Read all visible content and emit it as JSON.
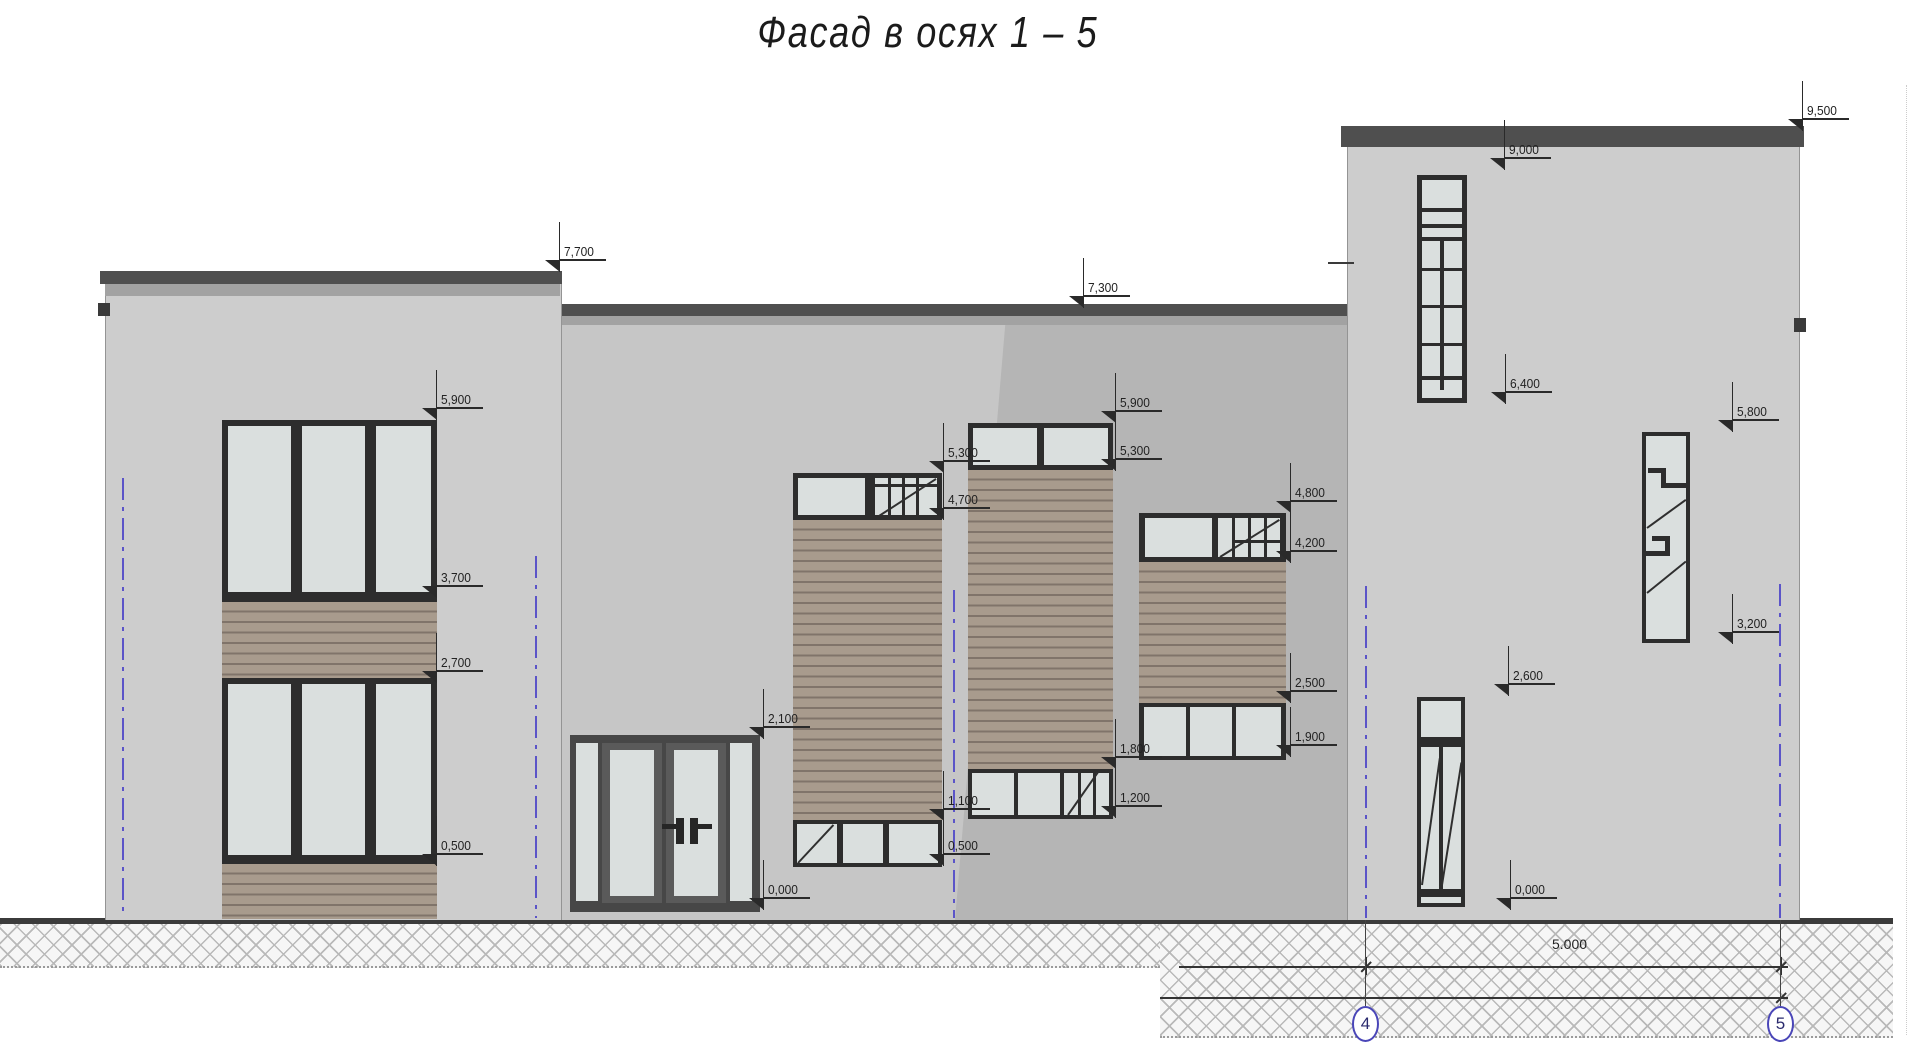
{
  "title": "Фасад в осях 1 – 5",
  "drawing": {
    "type": "architectural-elevation",
    "elevation_markers": [
      {
        "label": "7,700",
        "x": 560,
        "y": 272
      },
      {
        "label": "7,300",
        "x": 1084,
        "y": 308
      },
      {
        "label": "9,500",
        "x": 1803,
        "y": 131
      },
      {
        "label": "9,000",
        "x": 1505,
        "y": 170
      },
      {
        "label": "6,400",
        "x": 1506,
        "y": 404
      },
      {
        "label": "5,900",
        "x": 437,
        "y": 420
      },
      {
        "label": "3,700",
        "x": 437,
        "y": 598
      },
      {
        "label": "2,700",
        "x": 437,
        "y": 683
      },
      {
        "label": "0,500",
        "x": 437,
        "y": 866
      },
      {
        "label": "2,100",
        "x": 764,
        "y": 739
      },
      {
        "label": "0,000",
        "x": 764,
        "y": 910
      },
      {
        "label": "5,300",
        "x": 944,
        "y": 473
      },
      {
        "label": "4,700",
        "x": 944,
        "y": 520
      },
      {
        "label": "1,100",
        "x": 944,
        "y": 821
      },
      {
        "label": "0,500",
        "x": 944,
        "y": 866
      },
      {
        "label": "5,900",
        "x": 1116,
        "y": 423
      },
      {
        "label": "5,300",
        "x": 1116,
        "y": 471
      },
      {
        "label": "1,800",
        "x": 1116,
        "y": 769
      },
      {
        "label": "1,200",
        "x": 1116,
        "y": 818
      },
      {
        "label": "4,800",
        "x": 1291,
        "y": 513
      },
      {
        "label": "4,200",
        "x": 1291,
        "y": 563
      },
      {
        "label": "2,500",
        "x": 1291,
        "y": 703
      },
      {
        "label": "1,900",
        "x": 1291,
        "y": 757
      },
      {
        "label": "5,800",
        "x": 1733,
        "y": 432
      },
      {
        "label": "3,200",
        "x": 1733,
        "y": 644
      },
      {
        "label": "2,600",
        "x": 1509,
        "y": 696
      },
      {
        "label": "0,000",
        "x": 1511,
        "y": 910
      }
    ],
    "axes": {
      "lines": [
        {
          "x": 122,
          "top": 478
        },
        {
          "x": 535,
          "top": 556
        },
        {
          "x": 953,
          "top": 590
        },
        {
          "x": 1365,
          "top": 586
        },
        {
          "x": 1779,
          "top": 584
        }
      ],
      "bubbles": [
        {
          "label": "4",
          "x": 1366
        },
        {
          "label": "5",
          "x": 1781
        }
      ]
    },
    "dimension": {
      "label": "5.000"
    }
  },
  "colors": {
    "axis_blue": "#5b54c8",
    "bubble_blue": "#4a46b8",
    "wall": "#cdcdcd",
    "wall_shadow": "#b5b5b5",
    "wood": "#a89b8d",
    "glass": "#dadfde",
    "frame_dark": "#2d2d2d",
    "ground": "#3b3b3b"
  }
}
